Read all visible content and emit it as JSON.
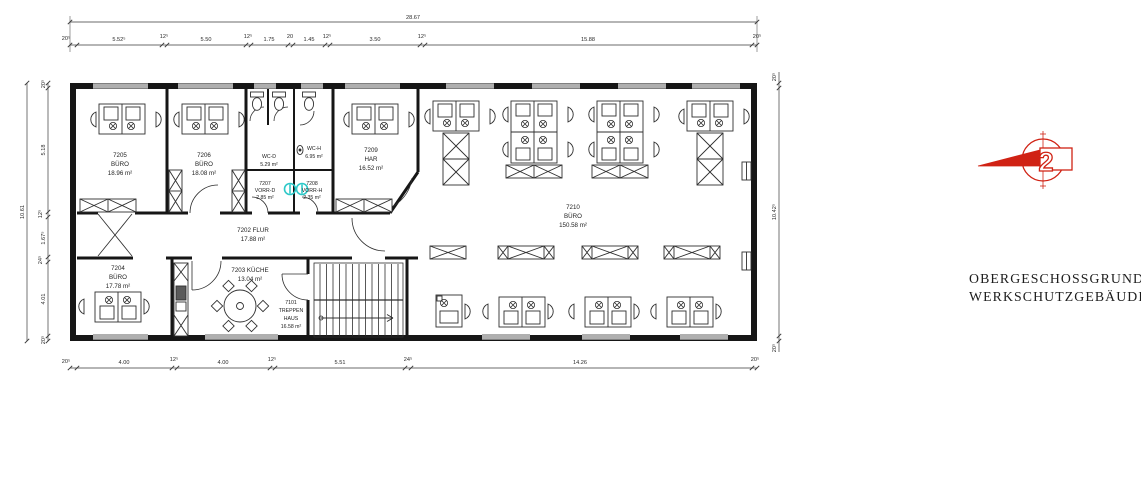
{
  "title_block": {
    "line1": "OBERGESCHOSSGRUNDRISS",
    "line2": "WERKSCHUTZGEBÄUDE"
  },
  "logo": {
    "floor_number": "2"
  },
  "colors": {
    "line": "#1c1c1c",
    "accent_red": "#d02214",
    "fixture_teal": "#2ec8c8"
  },
  "dimensions": {
    "top_total": "28.67",
    "left_total": "10.61",
    "top_chain": [
      "20⁵",
      "5.52⁵",
      "12⁵",
      "5.50",
      "12⁵",
      "1.75",
      "20",
      "1.45",
      "12⁵",
      "3.50",
      "12⁵",
      "15.88",
      "20⁵"
    ],
    "bottom_chain": [
      "20⁵",
      "4.00",
      "12⁵",
      "4.00",
      "12⁵",
      "5.51",
      "24⁵",
      "14.26",
      "20⁵"
    ],
    "left_chain": [
      "20⁵",
      "5.18",
      "12⁵",
      "1.67⁵",
      "24⁵",
      "4.01",
      "20⁵"
    ],
    "right_chain": [
      "20⁵",
      "10.42⁵",
      "20⁵"
    ]
  },
  "rooms": [
    {
      "line1": "7205",
      "line2": "BÜRO",
      "line3": "18.96 m²"
    },
    {
      "line1": "7206",
      "line2": "BÜRO",
      "line3": "18.08 m²"
    },
    {
      "line1": "WC-D",
      "line2": "5.29 m²"
    },
    {
      "line1": "WC-H",
      "line2": "6.95 m²"
    },
    {
      "line1": "7207",
      "line2": "VORR-D",
      "line3": "2.85 m²"
    },
    {
      "line1": "7208",
      "line2": "VORR-H",
      "line3": "2.35 m²"
    },
    {
      "line1": "7209",
      "line2": "HAR",
      "line3": "16.52 m²"
    },
    {
      "line1": "7202 FLUR",
      "line2": "17.88 m²"
    },
    {
      "line1": "7210",
      "line2": "BÜRO",
      "line3": "150.58 m²"
    },
    {
      "line1": "7204",
      "line2": "BÜRO",
      "line3": "17.78 m²"
    },
    {
      "line1": "7203 KÜCHE",
      "line2": "13.04 m²"
    },
    {
      "line1": "7101",
      "line2": "TREPPEN",
      "line3": "HAUS",
      "line4": "16.58 m²"
    }
  ]
}
